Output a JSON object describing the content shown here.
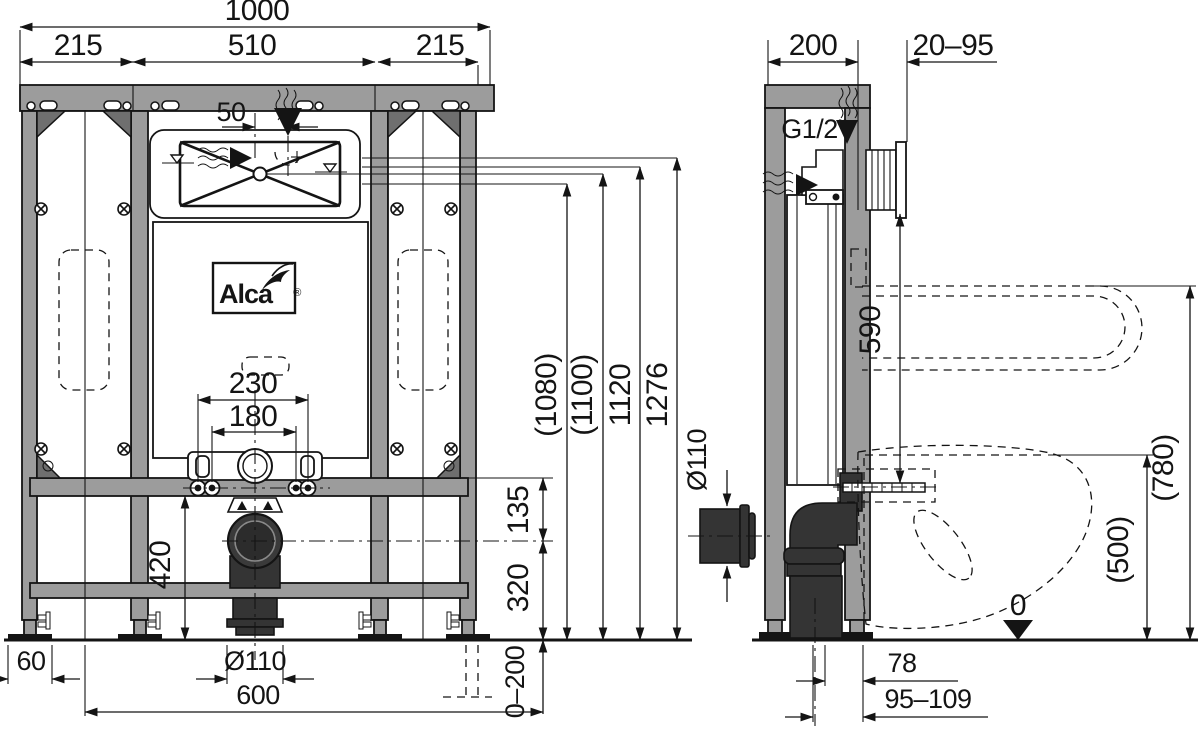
{
  "brand": {
    "name": "Alca",
    "registered": "®"
  },
  "views": {
    "front": {
      "dims": {
        "overall": "1000",
        "left": "215",
        "center": "510",
        "right": "215",
        "inlet_offset": "50",
        "fix_outer": "230",
        "fix_inner": "180",
        "h_1080": "(1080)",
        "h_1100": "(1100)",
        "h_1120": "1120",
        "h_total": "1276",
        "rail_offset": "135",
        "outlet_height": "320",
        "lower_height": "420",
        "foot": "60",
        "outlet_dia": "Ø110",
        "outlet_x": "600",
        "leg_range": "0–200"
      }
    },
    "side": {
      "dims": {
        "depth": "200",
        "wall_gap": "20–95",
        "thread": "G1/2\"",
        "flush_height": "590",
        "outlet_dia": "Ø110",
        "rail_height": "(780)",
        "seat_height": "(500)",
        "datum": "0",
        "outlet_face": "78",
        "outlet_range": "95–109"
      }
    }
  },
  "colors": {
    "frame": "#9c9c9c",
    "pipe": "#343434",
    "line": "#141414",
    "background": "#ffffff"
  }
}
